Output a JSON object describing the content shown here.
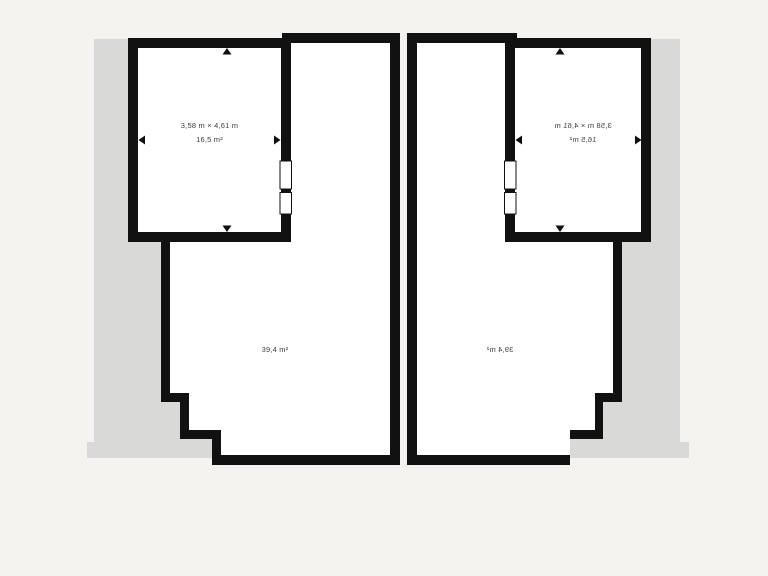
{
  "colors": {
    "background": "#f5f3f0",
    "shadow": "#d9d9d8",
    "wall": "#111111",
    "floor": "#ffffff",
    "text": "#3d3d3d"
  },
  "icons": {
    "measure_arrow": "triangle pointing at wall",
    "window": "white gap with thin outline in wall"
  },
  "units": {
    "left": {
      "name": "left unit",
      "mirrored_text": false,
      "room": {
        "dimensions": "3,58 m × 4,61 m",
        "area": "16,5 m²"
      },
      "living": {
        "area": "39,4 m²"
      }
    },
    "right": {
      "name": "right unit (mirror image)",
      "mirrored_text": true,
      "room": {
        "dimensions": "3,58 m × 4,61 m",
        "area": "16,5 m²"
      },
      "living": {
        "area": "39,4 m²"
      }
    }
  }
}
